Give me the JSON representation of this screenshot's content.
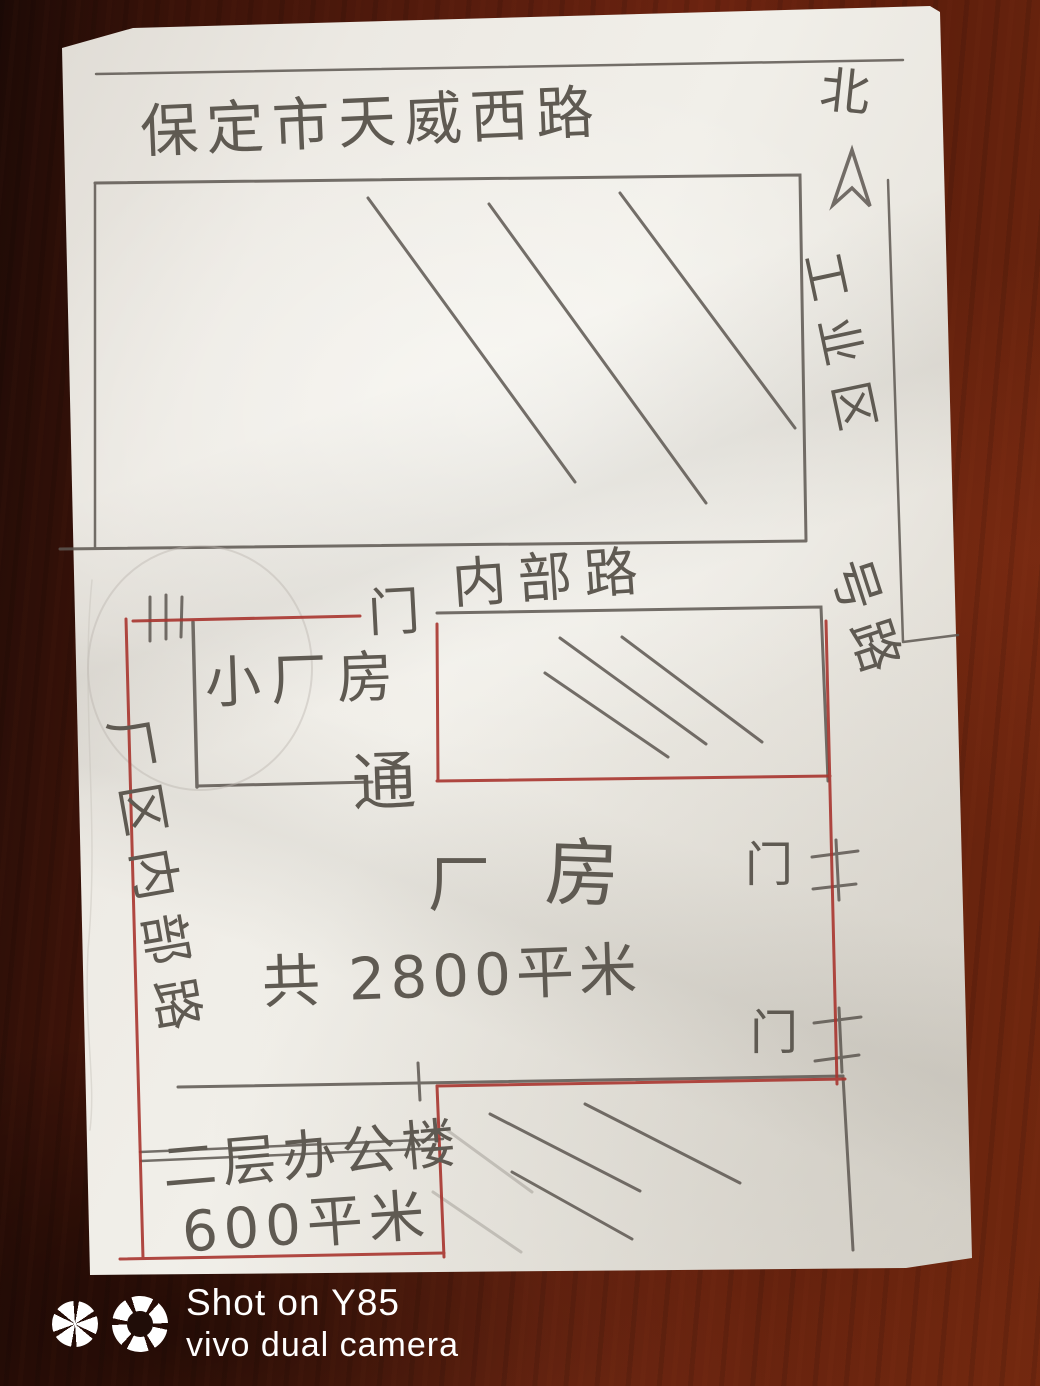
{
  "sketch": {
    "title": "保定市天威西路",
    "north_label": "北",
    "right_labels": {
      "zone": "工业区",
      "road": "号路"
    },
    "internal_road_label": "内部路",
    "left_road_label": "厂区内部路",
    "gate_top_label": "门",
    "small_factory_label": "小厂房",
    "passage_label": "通",
    "factory_char1": "厂",
    "factory_char2": "房",
    "area_total_label": "共 2800平米",
    "gate_right_upper_label": "门",
    "gate_right_lower_label": "门",
    "office_label_line1": "二层办公楼",
    "office_label_line2": "600平米"
  },
  "watermark": {
    "line1": "Shot on Y85",
    "line2": "vivo dual camera"
  },
  "icons": {
    "north_arrow": "upward-arrow-outline",
    "aperture_left": "camera-aperture",
    "aperture_right": "camera-aperture-ring"
  },
  "colors": {
    "pencil": "#5d5751",
    "red_pen": "#a8352f",
    "paper": "#ece9e3",
    "wood": "#571c0d",
    "watermark_text": "#ffffff"
  }
}
